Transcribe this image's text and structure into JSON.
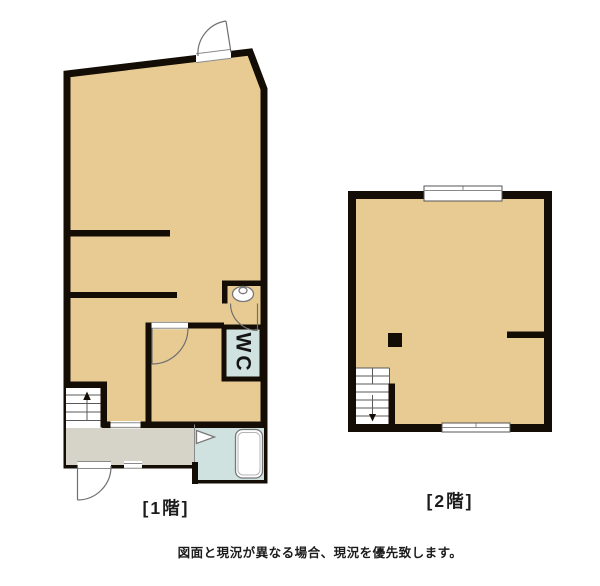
{
  "document": {
    "type": "real-estate-floor-plan",
    "background": "#ffffff"
  },
  "colors": {
    "wall": "#140d05",
    "floor": "#e8cb93",
    "entrance": "#d6d4c9",
    "wet_area": "#cfe2e0",
    "fixture_line": "#777777",
    "stairs": "#ffffff"
  },
  "floor1": {
    "label": "[1階]",
    "wc_label": "WC"
  },
  "floor2": {
    "label": "[2階]"
  },
  "footer": {
    "disclaimer": "図面と現況が異なる場合、現況を優先致します。"
  }
}
